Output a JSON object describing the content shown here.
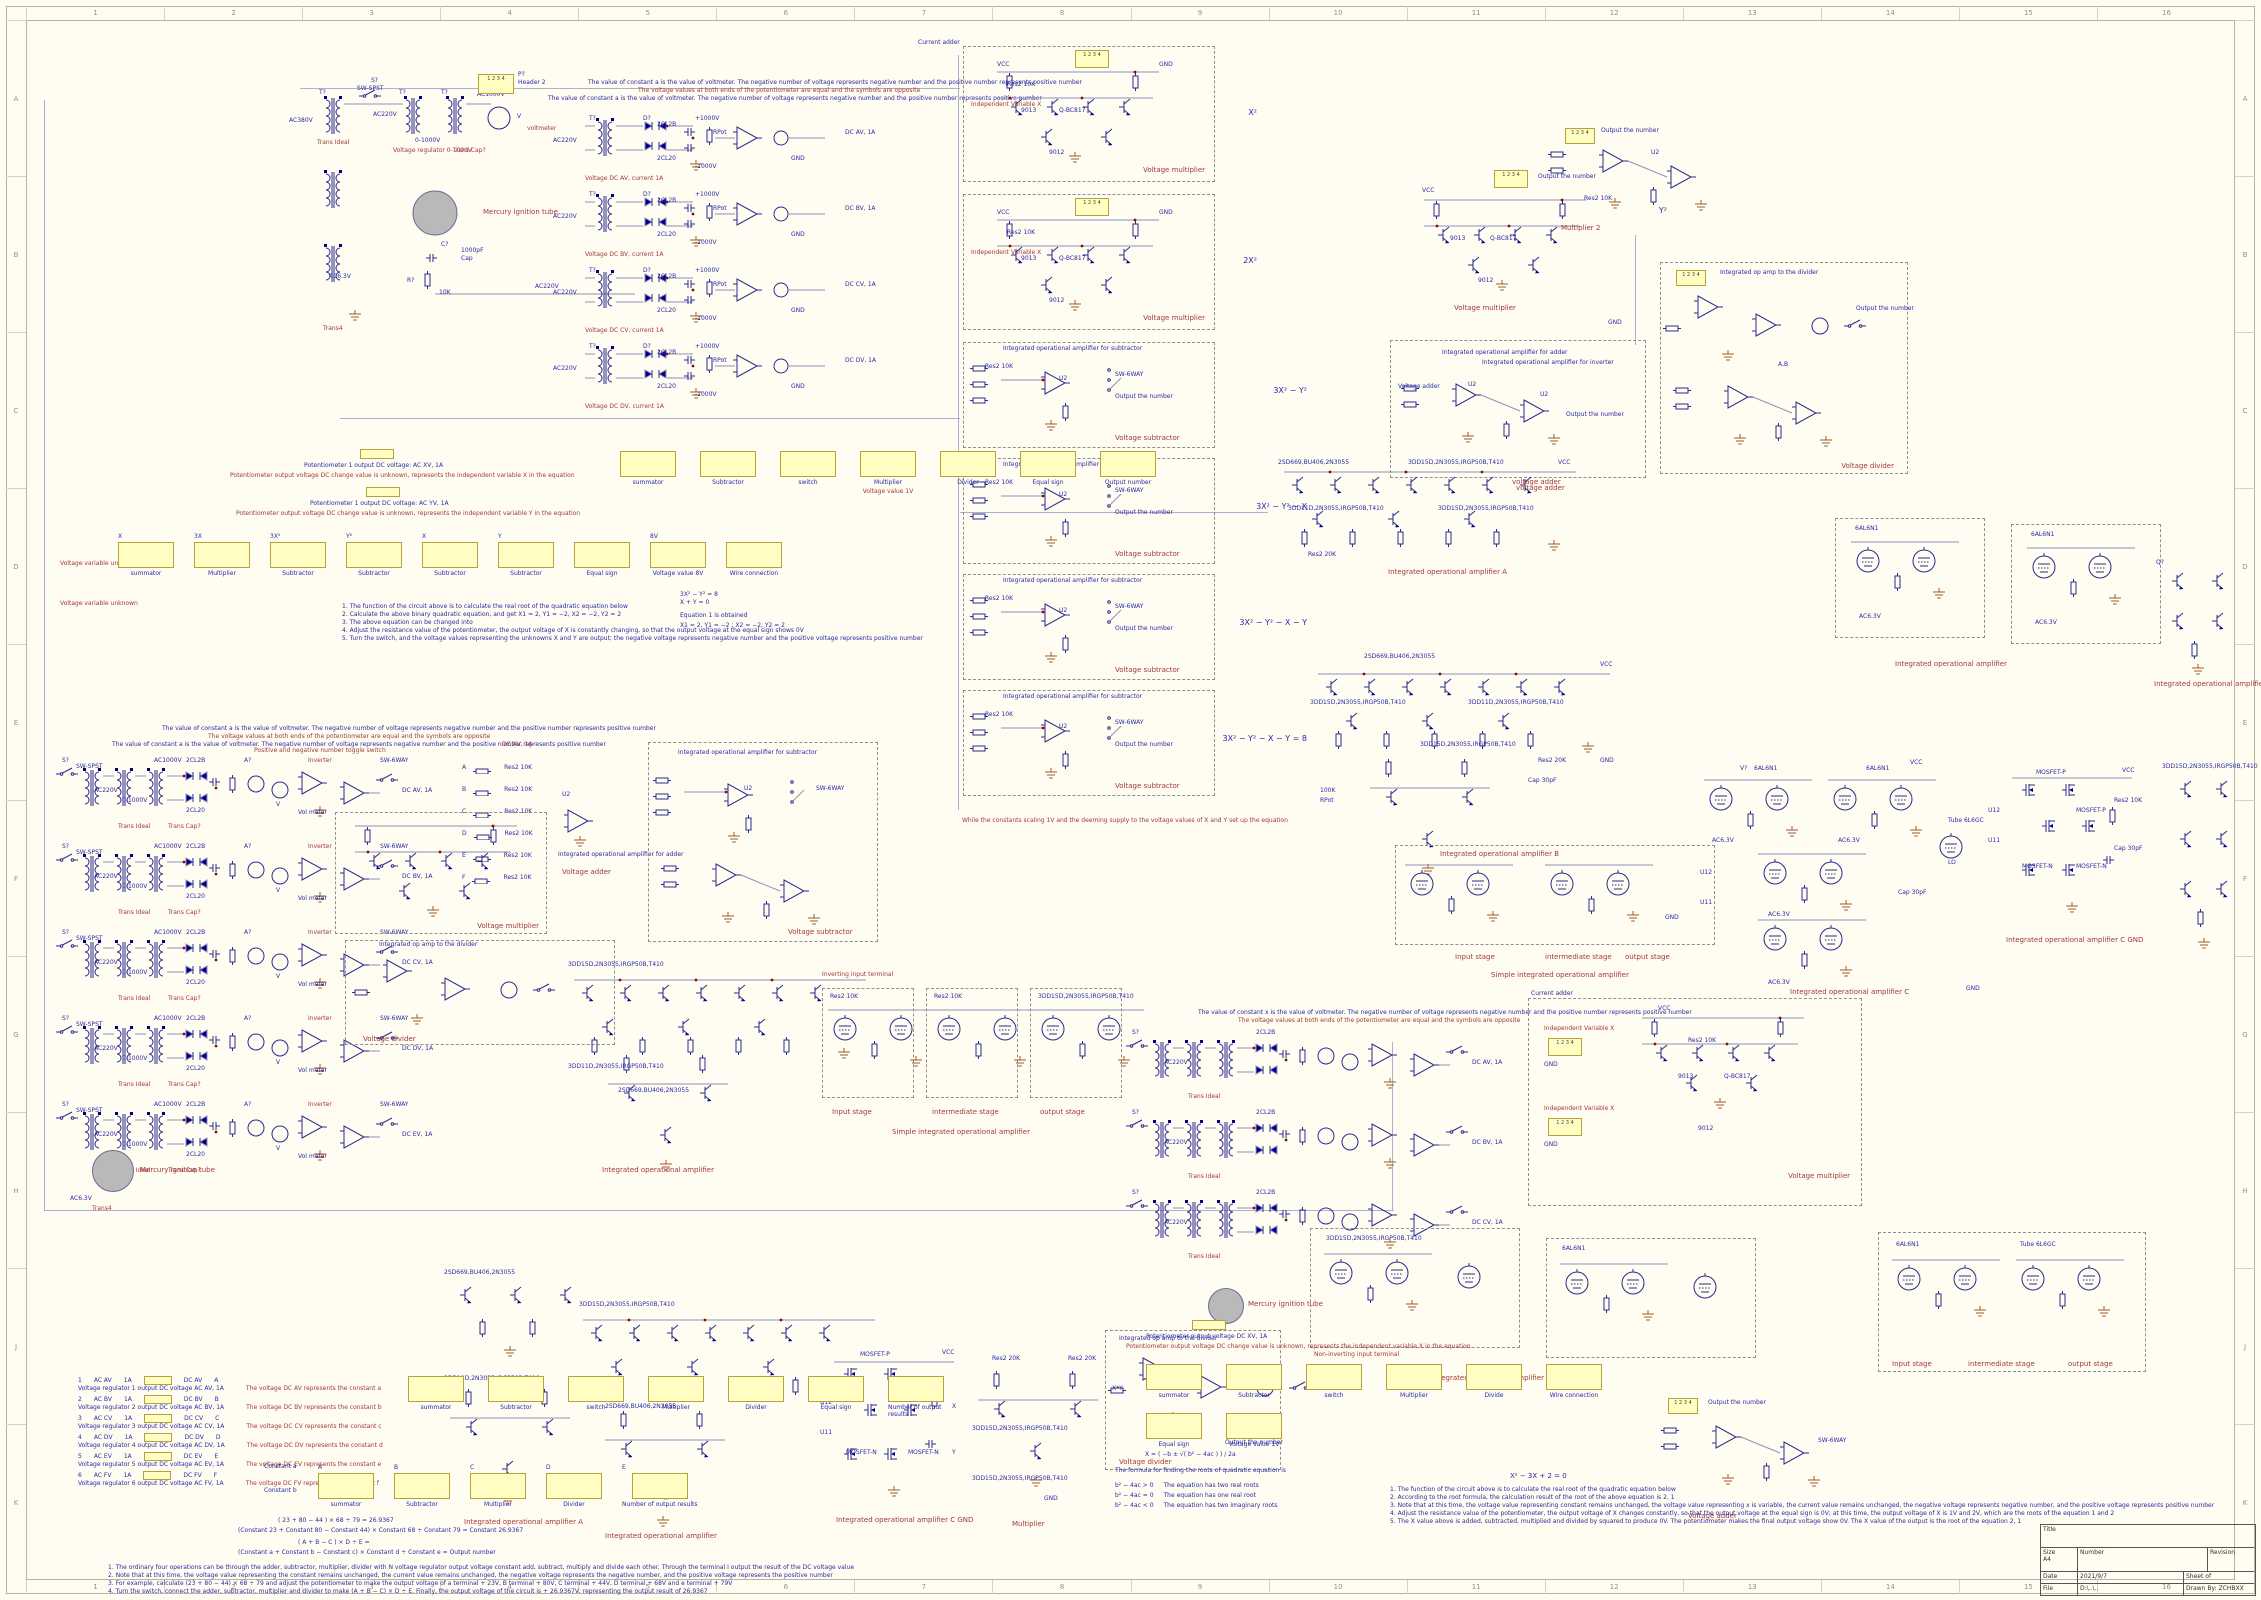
{
  "frame": {
    "cols": [
      "1",
      "2",
      "3",
      "4",
      "5",
      "6",
      "7",
      "8",
      "9",
      "10",
      "11",
      "12",
      "13",
      "14",
      "15",
      "16"
    ],
    "rows": [
      "A",
      "B",
      "C",
      "D",
      "E",
      "F",
      "G",
      "H",
      "J",
      "K"
    ]
  },
  "title_block": {
    "title_label": "Title",
    "size_label": "Size",
    "size": "A4",
    "number_label": "Number",
    "revision_label": "Revision",
    "date_label": "Date",
    "date": "2021/9/7",
    "sheet_label": "Sheet",
    "sheet_of": "of",
    "file_label": "File",
    "file": "D:\\..\\..",
    "drawn_label": "Drawn By:",
    "drawn": "ZCHBXX"
  },
  "notes": {
    "const1": "The value of constant a is the value of voltmeter. The negative number of voltage represents negative number and the positive number represents positive number",
    "const2": "The voltage values at both ends of the potentiometer are equal and the symbols are opposite",
    "constx": "The value of constant x is the value of voltmeter. The negative number of voltage represents negative number and the positive number represents positive number",
    "while_eq": "While the constants scaling 1V and the deeming supply to the voltage values of X and Y set up the equation"
  },
  "terms": {
    "tq": "T?",
    "sq": "S?",
    "rq": "R?",
    "cq": "C?",
    "dq": "D?",
    "qq": "Q?",
    "vq": "V?",
    "pq": "P?",
    "u2": "U2",
    "u11": "U11",
    "u12": "U12",
    "x": "X",
    "y": "Y",
    "ab": "A,B",
    "sw_spst": "SW-SPST",
    "sw_spdt": "SW-SPDT",
    "sw_6way": "SW-6WAY",
    "ac380": "AC380V",
    "ac220": "AC220V",
    "ac1000": "AC1000V",
    "ac63": "AC6.3V",
    "p1000": "+1000V",
    "n1000": "-1000V",
    "vcc": "VCC",
    "gnd": "GND",
    "rng": "0-1000V",
    "reg": "Voltage regulator 0-1000V",
    "trans_ideal": "Trans Ideal",
    "trans_cap": "Trans Cap?",
    "trans4": "Trans4",
    "header2": "Header 2",
    "mercury": "Mercury ignition tube",
    "voltmeter": "voltmeter",
    "volmeter": "Vol meter",
    "aq": "A?",
    "vm": "V",
    "cap1000": "1000pF",
    "cap_lbl": "Cap",
    "cap30": "Cap 30pF",
    "res10k": "Res2 10K",
    "res20k": "Res2 20K",
    "rpot": "RPot",
    "r100k": "100K",
    "r10k": "10K",
    "d2cl2b": "2CL2B",
    "d2cl20": "2CL20",
    "q9013": "9013",
    "q9012": "9012",
    "qbc817": "Q-BC817",
    "pt1": "2SD669,BU406,2N3055",
    "pt2": "3DD15D,2N3055,IRGP50B,T410",
    "pt3": "3DD11D,2N3055,IRGP50B,T410",
    "tube1": "6AL6N1",
    "tube2": "Tube 6L6GC",
    "mosp": "MOSFET-P",
    "mosn": "MOSFET-N",
    "ivx": "Independent Variable X",
    "outnum": "Output the number",
    "vmult": "Voltage multiplier",
    "vsub": "Voltage subtractor",
    "vadd": "Voltage adder",
    "vdiv": "Voltage divider",
    "vadd_lc": "voltage adder",
    "ioa": "Integrated operational amplifier",
    "ioa_sub": "Integrated operational amplifier for subtractor",
    "ioa_add": "Integrated operational amplifier for adder",
    "ioa_inv": "Integrated operational amplifier for inverter",
    "ioa_div": "Integrated op amp to the divider",
    "ioa_a": "Integrated operational amplifier A",
    "ioa_b": "Integrated operational amplifier B",
    "ioa_c": "Integrated operational amplifier C",
    "ioa_cg": "Integrated operational amplifier C GND",
    "simple_ioa": "Simple integrated operational amplifier",
    "cur_add": "Current adder",
    "inverter": "Inverter",
    "pn_toggle": "Positive and negative number toggle switch",
    "stage_in": "Input stage",
    "stage_mid": "intermediate stage",
    "stage_out": "output stage",
    "inv_term": "Inverting input terminal",
    "ninv_term": "Non-inverting input terminal",
    "mult": "Multiplier",
    "mult2": "Multiplier 2",
    "xy": "X*Y",
    "pin12": "1  2",
    "pin34": "3  4",
    "vvu": "Voltage variable unknown",
    "y2": "Y²",
    "lo": "LO"
  },
  "mult_boxes": [
    {
      "ann": "X²"
    },
    {
      "ann": "2X²"
    }
  ],
  "sub_boxes": [
    {
      "ann": "3X² − Y²"
    },
    {
      "ann": "3X² − Y² − X"
    },
    {
      "ann": "3X² − Y² − X − Y"
    },
    {
      "ann": "3X² − Y² − X − Y = 8"
    }
  ],
  "rect_rows": [
    {
      "dc": "DC AV, 1A",
      "cap": "Voltage DC AV, current 1A"
    },
    {
      "dc": "DC BV, 1A",
      "cap": "Voltage DC BV, current 1A"
    },
    {
      "dc": "DC CV, 1A",
      "cap": "Voltage DC CV, current 1A"
    },
    {
      "dc": "DC DV, 1A",
      "cap": "Voltage DC DV, current 1A"
    }
  ],
  "left_rows": [
    {
      "dc": "DC AV, 1A"
    },
    {
      "dc": "DC BV, 1A"
    },
    {
      "dc": "DC CV, 1A"
    },
    {
      "dc": "DC DV, 1A"
    },
    {
      "dc": "DC EV, 1A"
    }
  ],
  "center_rows": [
    {
      "dc": "DC AV, 1A"
    },
    {
      "dc": "DC BV, 1A"
    },
    {
      "dc": "DC CV, 1A"
    }
  ],
  "sel_rows": [
    {
      "k": "A"
    },
    {
      "k": "B"
    },
    {
      "k": "C"
    },
    {
      "k": "D"
    },
    {
      "k": "E"
    },
    {
      "k": "F"
    }
  ],
  "legend1": {
    "pot_x1": "Potentiometer 1 output DC voltage: AC XV, 1A",
    "pot_x2": "Potentiometer output voltage DC change value is unknown, represents the independent variable X in the equation",
    "pot_y1": "Potentiometer 1 output DC voltage: AC YV, 1A",
    "pot_y2": "Potentiometer output voltage DC change value is unknown, represents the independent variable Y in the equation",
    "symbols": [
      {
        "label": "summator",
        "sub": ""
      },
      {
        "label": "Subtractor",
        "sub": ""
      },
      {
        "label": "switch",
        "sub": ""
      },
      {
        "label": "Multiplier",
        "sub": "Voltage value 1V"
      },
      {
        "label": "Divider",
        "sub": ""
      },
      {
        "label": "Equal sign",
        "sub": ""
      },
      {
        "label": "Output number",
        "sub": ""
      }
    ],
    "flow_left": "Voltage variable unknown",
    "flow": [
      {
        "pre": "X",
        "label": "summator"
      },
      {
        "pre": "3X",
        "label": "Multiplier"
      },
      {
        "pre": "3X²",
        "label": "Subtractor"
      },
      {
        "pre": "Y²",
        "label": "Subtractor"
      },
      {
        "pre": "X",
        "label": "Subtractor"
      },
      {
        "pre": "Y",
        "label": "Subtractor"
      },
      {
        "pre": "",
        "label": "Equal sign"
      },
      {
        "pre": "8V",
        "label": "Voltage value 8V"
      },
      {
        "pre": "",
        "label": "Wire connection"
      }
    ],
    "equations": [
      "3X² − Y² = 8",
      "X + Y = 0"
    ],
    "eq_note": "Equation 1 is obtained",
    "roots": "X1 = 2, Y1 = −2 ;  X2 = −2, Y2 = 2",
    "notes": [
      "1. The function of the circuit above is to calculate the real root of the quadratic equation below",
      "2. Calculate the above binary quadratic equation, and get X1 = 2, Y1 = −2, X2 = −2, Y2 = 2",
      "3. The above equation can be changed into",
      "4. Adjust the resistance value of the potentiometer, the output voltage of X is constantly changing, so that the output voltage at the equal sign shows 0V",
      "5. Turn the switch, and the voltage values representing the unknowns X and Y are output; the negative voltage represents negative number and the positive voltage represents positive number"
    ]
  },
  "legend2": {
    "rows": [
      {
        "n": "1",
        "ac": "AC AV",
        "amp": "1A",
        "dc": "DC AV",
        "k": "A",
        "l1": "Voltage regulator 1 output DC voltage AC AV, 1A",
        "l2": "The voltage DC AV represents the constant a"
      },
      {
        "n": "2",
        "ac": "AC BV",
        "amp": "1A",
        "dc": "DC BV",
        "k": "B",
        "l1": "Voltage regulator 2 output DC voltage AC BV, 1A",
        "l2": "The voltage DC BV represents the constant b"
      },
      {
        "n": "3",
        "ac": "AC CV",
        "amp": "1A",
        "dc": "DC CV",
        "k": "C",
        "l1": "Voltage regulator 3 output DC voltage AC CV, 1A",
        "l2": "The voltage DC CV represents the constant c"
      },
      {
        "n": "4",
        "ac": "AC DV",
        "amp": "1A",
        "dc": "DC DV",
        "k": "D",
        "l1": "Voltage regulator 4 output DC voltage AC DV, 1A",
        "l2": "The voltage DC DV represents the constant d"
      },
      {
        "n": "5",
        "ac": "AC EV",
        "amp": "1A",
        "dc": "DC EV",
        "k": "E",
        "l1": "Voltage regulator 5 output DC voltage AC EV, 1A",
        "l2": "The voltage DC EV represents the constant e"
      },
      {
        "n": "6",
        "ac": "AC FV",
        "amp": "1A",
        "dc": "DC FV",
        "k": "F",
        "l1": "Voltage regulator 6 output DC voltage AC FV, 1A",
        "l2": "The voltage DC FV represents the constant f"
      }
    ],
    "symbols": [
      {
        "label": "summator"
      },
      {
        "label": "Subtractor"
      },
      {
        "label": "switch"
      },
      {
        "label": "Multiplier"
      },
      {
        "label": "Divider"
      },
      {
        "label": "Equal sign"
      },
      {
        "label": "Number of output results"
      }
    ],
    "flow_in1": "Constant a",
    "flow_in2": "Constant b",
    "flow": [
      {
        "pre": "A",
        "label": "summator"
      },
      {
        "pre": "B",
        "label": "Subtractor"
      },
      {
        "pre": "C",
        "label": "Multiplier"
      },
      {
        "pre": "D",
        "label": "Divider"
      },
      {
        "pre": "E",
        "label": "Number of output results"
      }
    ],
    "example1": "( 23 + 80 − 44 ) × 68 ÷ 79 = 26.9367",
    "example2": "(Constant 23 + Constant 80 − Constant 44) × Constant 68 ÷ Constant 79 = Constant 26.9367",
    "formula1": "( A + B − C ) × D ÷ E =",
    "formula2": "(Constant a + Constant b − Constant c) × Constant d ÷ Constant e  =  Output number",
    "notes": [
      "1. The ordinary four operations can be through the adder, subtractor, multiplier, divider with N voltage regulator output voltage constant add, subtract, multiply and divide each other. Through the terminal I output the result of the DC voltage value",
      "2. Note that at this time, the voltage value representing the constant remains unchanged, the current value remains unchanged, the negative voltage represents the negative number, and the positive voltage represents the positive number",
      "3. For example, calculate (23 + 80 − 44) × 68 ÷ 79 and adjust the potentiometer to make the output voltage of a terminal + 23V, B terminal + 80V, C terminal + 44V, D terminal + 68V and e terminal + 79V",
      "4. Turn the switch, connect the adder, subtractor, multiplier and divider to make (A + B − C) × D ÷ E. Finally, the output voltage of the circuit is + 26.9367V, representing the output result of 26.9367"
    ]
  },
  "legend3": {
    "pot1": "Potentiometer output voltage DC XV, 1A",
    "pot2": "Potentiometer output voltage DC change value is unknown, represents the independent variable X in the equation",
    "symbols": [
      {
        "label": "summator"
      },
      {
        "label": "Subtractor"
      },
      {
        "label": "switch"
      },
      {
        "label": "Multiplier"
      },
      {
        "label": "Divide"
      },
      {
        "label": "Wire connection"
      },
      {
        "label": "Equal sign"
      },
      {
        "label": "Voltage value 1V"
      }
    ],
    "eq": "X² − 3X + 2 = 0",
    "notes": [
      "1. The function of the circuit above is to calculate the real root of the quadratic equation below",
      "2. According to the root formula, the calculation result of the root of the above equation is 2, 1",
      "3. Note that at this time, the voltage value representing constant remains unchanged, the voltage value representing x is variable, the current value remains unchanged, the negative voltage represents negative number, and the positive voltage represents positive number",
      "4. Adjust the resistance value of the potentiometer, the output voltage of X changes constantly, so that the output voltage at the equal sign is 0V; at this time, the output voltage of X is 1V and 2V, which are the roots of the equation 1 and 2",
      "5. The X value above is added, subtracted, multiplied and divided by squared to produce 0V. The potentiometer makes the final output voltage show 0V. The X value of the output is the root of the equation 2, 1"
    ],
    "formula_title": "The formula for finding the roots of quadratic equation is",
    "formula": "X = ( −b ± √( b² − 4ac ) ) / 2a",
    "cases": [
      {
        "cond": "b² − 4ac > 0",
        "res": "The equation has two real roots"
      },
      {
        "cond": "b² − 4ac = 0",
        "res": "The equation has one real root"
      },
      {
        "cond": "b² − 4ac < 0",
        "res": "The equation has two imaginary roots"
      }
    ]
  }
}
